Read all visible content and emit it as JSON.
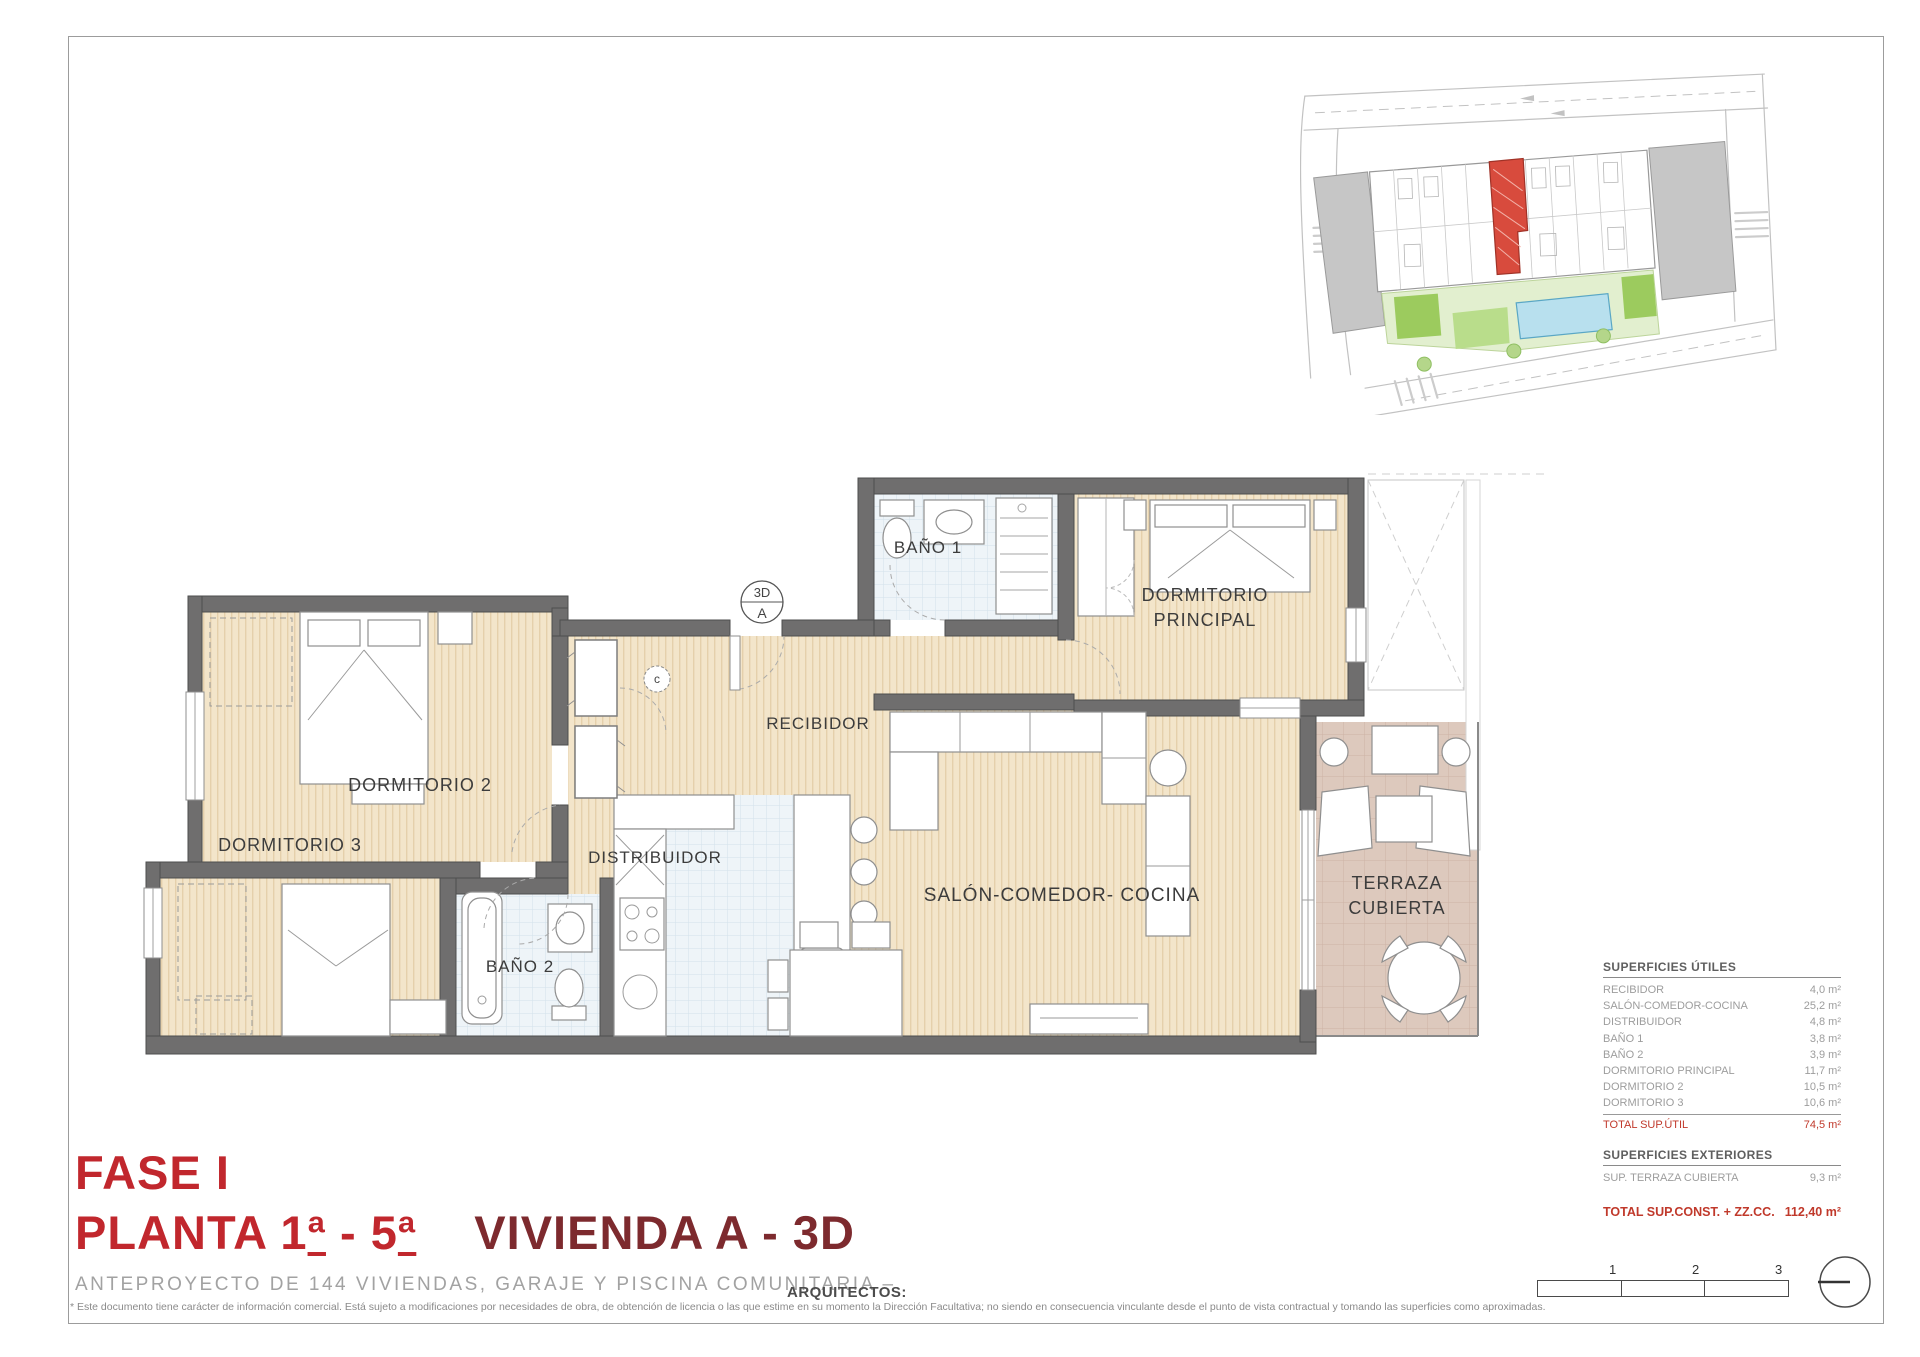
{
  "title_block": {
    "fase": "FASE I",
    "planta": "PLANTA 1ª - 5ª",
    "vivienda": "VIVIENDA A - 3D",
    "subtitle": "ANTEPROYECTO DE 144 VIVIENDAS, GARAJE Y PISCINA COMUNITARIA –",
    "architects_label": "ARQUITECTOS:",
    "disclaimer": "* Este documento tiene carácter de información comercial. Está sujeto a modificaciones por necesidades de obra, de obtención de licencia o las que estime en su momento la Dirección Facultativa; no siendo en consecuencia vinculante desde el punto de vista contractual y tomando las superficies como aproximadas."
  },
  "floor_plan": {
    "rooms": [
      {
        "id": "bano1",
        "lines": [
          "BAÑO 1"
        ],
        "x": 928,
        "y": 553,
        "size": 17
      },
      {
        "id": "dormitorio-principal",
        "lines": [
          "DORMITORIO",
          "PRINCIPAL"
        ],
        "x": 1205,
        "y": 601,
        "size": 18
      },
      {
        "id": "recibidor",
        "lines": [
          "RECIBIDOR"
        ],
        "x": 818,
        "y": 729,
        "size": 17
      },
      {
        "id": "dormitorio-2",
        "lines": [
          "DORMITORIO 2"
        ],
        "x": 420,
        "y": 791,
        "size": 18
      },
      {
        "id": "dormitorio-3",
        "lines": [
          "DORMITORIO 3"
        ],
        "x": 290,
        "y": 851,
        "size": 18
      },
      {
        "id": "distribuidor",
        "lines": [
          "DISTRIBUIDOR"
        ],
        "x": 655,
        "y": 863,
        "size": 17
      },
      {
        "id": "bano2",
        "lines": [
          "BAÑO 2"
        ],
        "x": 520,
        "y": 972,
        "size": 17
      },
      {
        "id": "salon-comedor-cocina",
        "lines": [
          "SALÓN-COMEDOR- COCINA"
        ],
        "x": 1062,
        "y": 901,
        "size": 19
      },
      {
        "id": "terraza-cubierta",
        "lines": [
          "TERRAZA",
          "CUBIERTA"
        ],
        "x": 1397,
        "y": 889,
        "size": 18
      }
    ],
    "symbols": {
      "section_marker": {
        "top": "3D",
        "bottom": "A",
        "x": 762,
        "y": 602,
        "r": 21
      },
      "c_marker": {
        "label": "c",
        "x": 657,
        "y": 679,
        "r": 13
      }
    }
  },
  "surfaces": {
    "utiles": {
      "header": "SUPERFICIES ÚTILES",
      "rows": [
        {
          "label": "RECIBIDOR",
          "value": "4,0 m²"
        },
        {
          "label": "SALÓN-COMEDOR-COCINA",
          "value": "25,2 m²"
        },
        {
          "label": "DISTRIBUIDOR",
          "value": "4,8 m²"
        },
        {
          "label": "BAÑO 1",
          "value": "3,8 m²"
        },
        {
          "label": "BAÑO 2",
          "value": "3,9 m²"
        },
        {
          "label": "DORMITORIO PRINCIPAL",
          "value": "11,7 m²"
        },
        {
          "label": "DORMITORIO 2",
          "value": "10,5 m²"
        },
        {
          "label": "DORMITORIO 3",
          "value": "10,6 m²"
        }
      ],
      "total": {
        "label": "TOTAL SUP.ÚTIL",
        "value": "74,5 m²"
      }
    },
    "exteriores": {
      "header": "SUPERFICIES EXTERIORES",
      "rows": [
        {
          "label": "SUP. TERRAZA CUBIERTA",
          "value": "9,3 m²"
        }
      ]
    },
    "total_const": {
      "label": "TOTAL SUP.CONST. + ZZ.CC.",
      "value": "112,40 m²"
    }
  },
  "scale_bar": {
    "labels": [
      "1",
      "2",
      "3"
    ]
  },
  "colors": {
    "title_red": "#c1272d",
    "title_maroon": "#7d2a2e",
    "table_red": "#c0392b",
    "wall": "#6f6e6e",
    "wood": "#f3e5ca",
    "tile": "#eef4f8",
    "terrace": "#ddc9bd",
    "site_highlight": "#d84b3d",
    "pool": "#b8e0ee",
    "green": "#a5cf72"
  }
}
